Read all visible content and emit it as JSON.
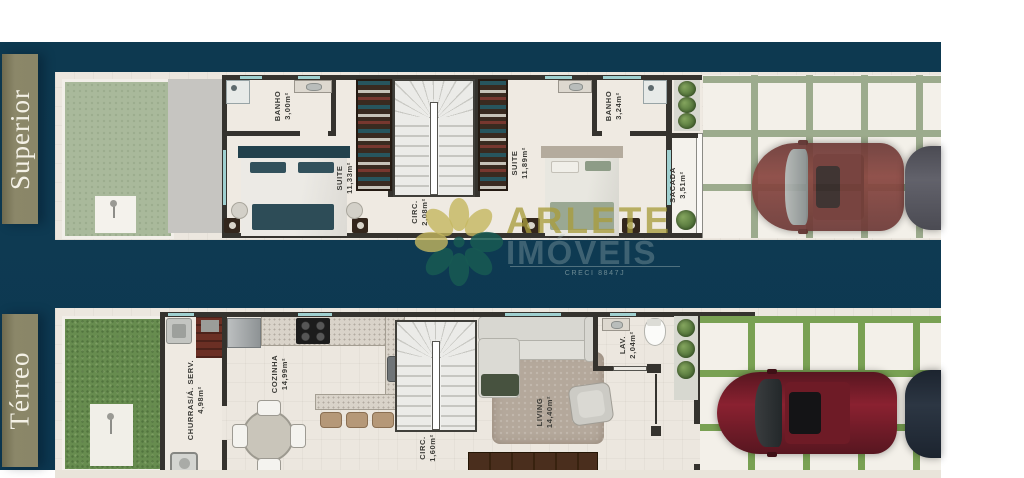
{
  "floors": [
    {
      "band_label": "Superior",
      "rooms": [
        {
          "name": "BANHO",
          "area": "3,00m²"
        },
        {
          "name": "SUITE",
          "area": "11,33m²"
        },
        {
          "name": "CIRC.",
          "area": "2,08m²"
        },
        {
          "name": "SUITE",
          "area": "11,89m²"
        },
        {
          "name": "BANHO",
          "area": "3,24m²"
        },
        {
          "name": "SACADA",
          "area": "3,51m²"
        }
      ]
    },
    {
      "band_label": "Térreo",
      "rooms": [
        {
          "name": "CHURRAS/Á. SERV.",
          "area": "4,98m²"
        },
        {
          "name": "COZINHA",
          "area": "14,99m²"
        },
        {
          "name": "CIRC.",
          "area": "1,60m²"
        },
        {
          "name": "LIVING",
          "area": "14,40m²"
        },
        {
          "name": "LAV.",
          "area": "2,04m²"
        }
      ]
    }
  ],
  "watermark": {
    "brand_line1": "ARLETE",
    "brand_line2": "IMÓVEIS",
    "license": "CRECI 8847J"
  },
  "colors": {
    "background_navy": "#0e3a52",
    "band_olive": "#8a8667",
    "plan_floor_cream": "#ece7df",
    "garden_sage_upper": "#a9b99b",
    "garden_grass_lower": "#678c4f",
    "tile_joint_upper": "#9cab8d",
    "tile_joint_lower": "#79a153",
    "wall_dark": "#35332e",
    "glass_teal": "#9fd0d0",
    "car_red": "#7e2430",
    "brand_yellow": "#b3a74e",
    "brand_gray": "#9fb4b4"
  }
}
